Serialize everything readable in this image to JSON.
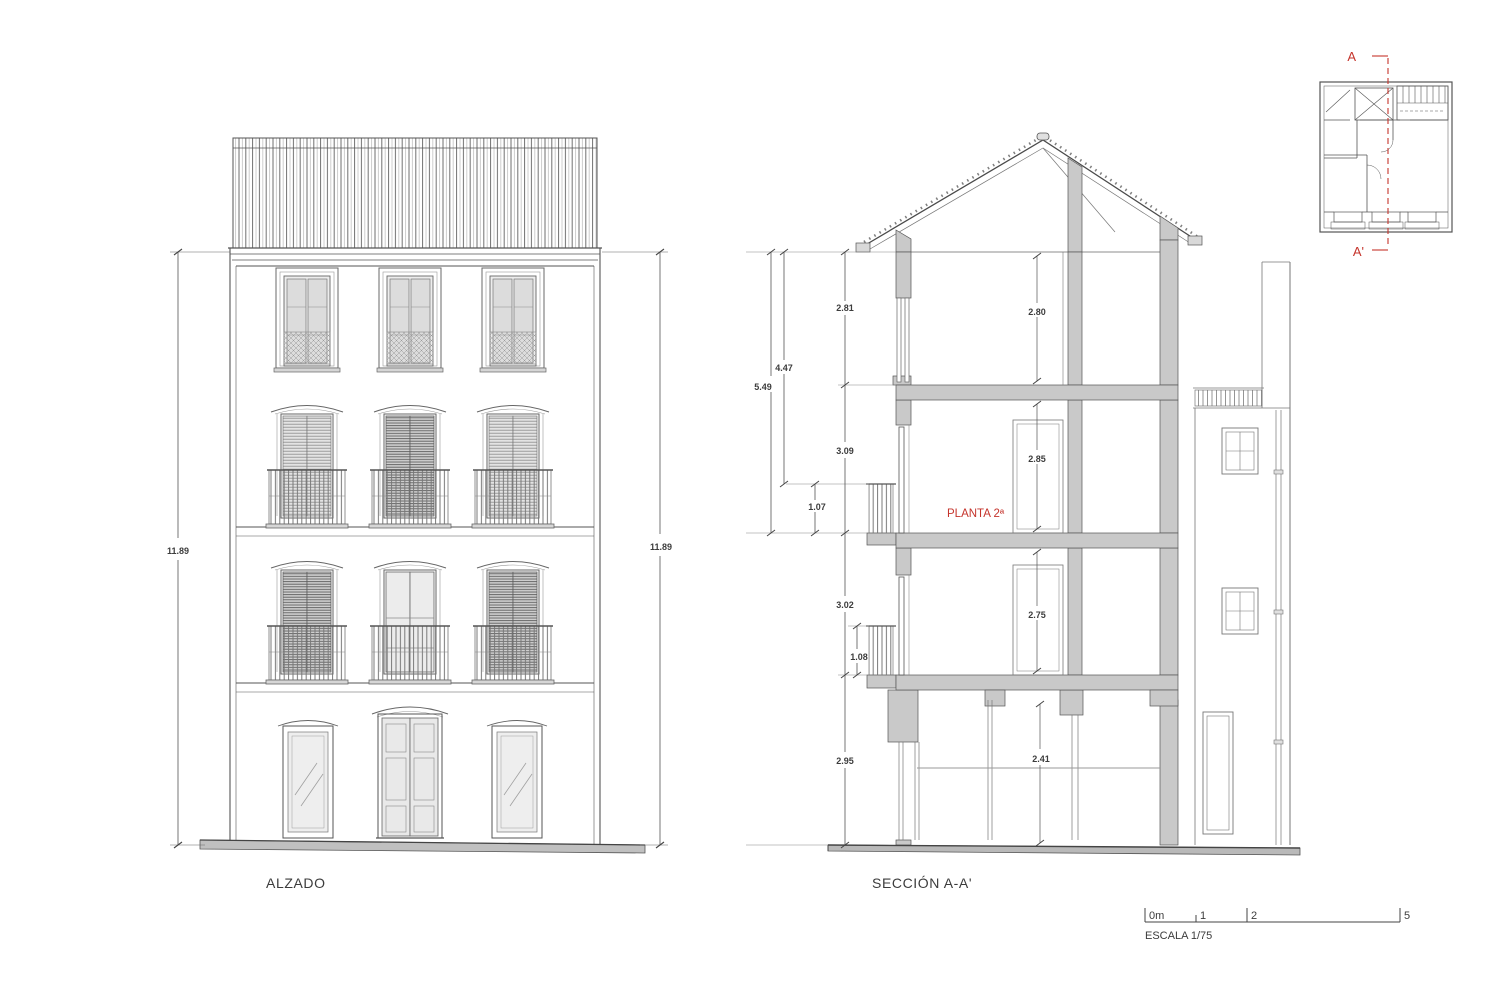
{
  "colors": {
    "line": "#4a4a4a",
    "wall_fill": "#c9c9c9",
    "glass_fill": "#e3e3e3",
    "ground_fill": "#bcbcbc",
    "section_mark_red": "#c5342c"
  },
  "elevation": {
    "title": "ALZADO",
    "dim_height_left": "11.89",
    "dim_height_right": "11.89"
  },
  "section": {
    "title": "SECCIÓN A-A'",
    "floor_label": "PLANTA 2ª",
    "dims_left_chain": {
      "top_floor": "2.81",
      "second_floor": "3.09",
      "first_floor": "3.02",
      "ground_floor": "2.95"
    },
    "dims_left_aux": {
      "total_upper": "5.49",
      "to_railing": "4.47",
      "railing_second": "1.07",
      "railing_first": "1.08"
    },
    "dims_interior": {
      "top_room": "2.80",
      "second_room": "2.85",
      "first_room": "2.75",
      "ground_room": "2.41"
    }
  },
  "key_plan": {
    "section_mark_start": "A",
    "section_mark_end": "A'"
  },
  "scale_bar": {
    "ticks": [
      "0m",
      "1",
      "2",
      "5"
    ],
    "label": "ESCALA 1/75"
  }
}
